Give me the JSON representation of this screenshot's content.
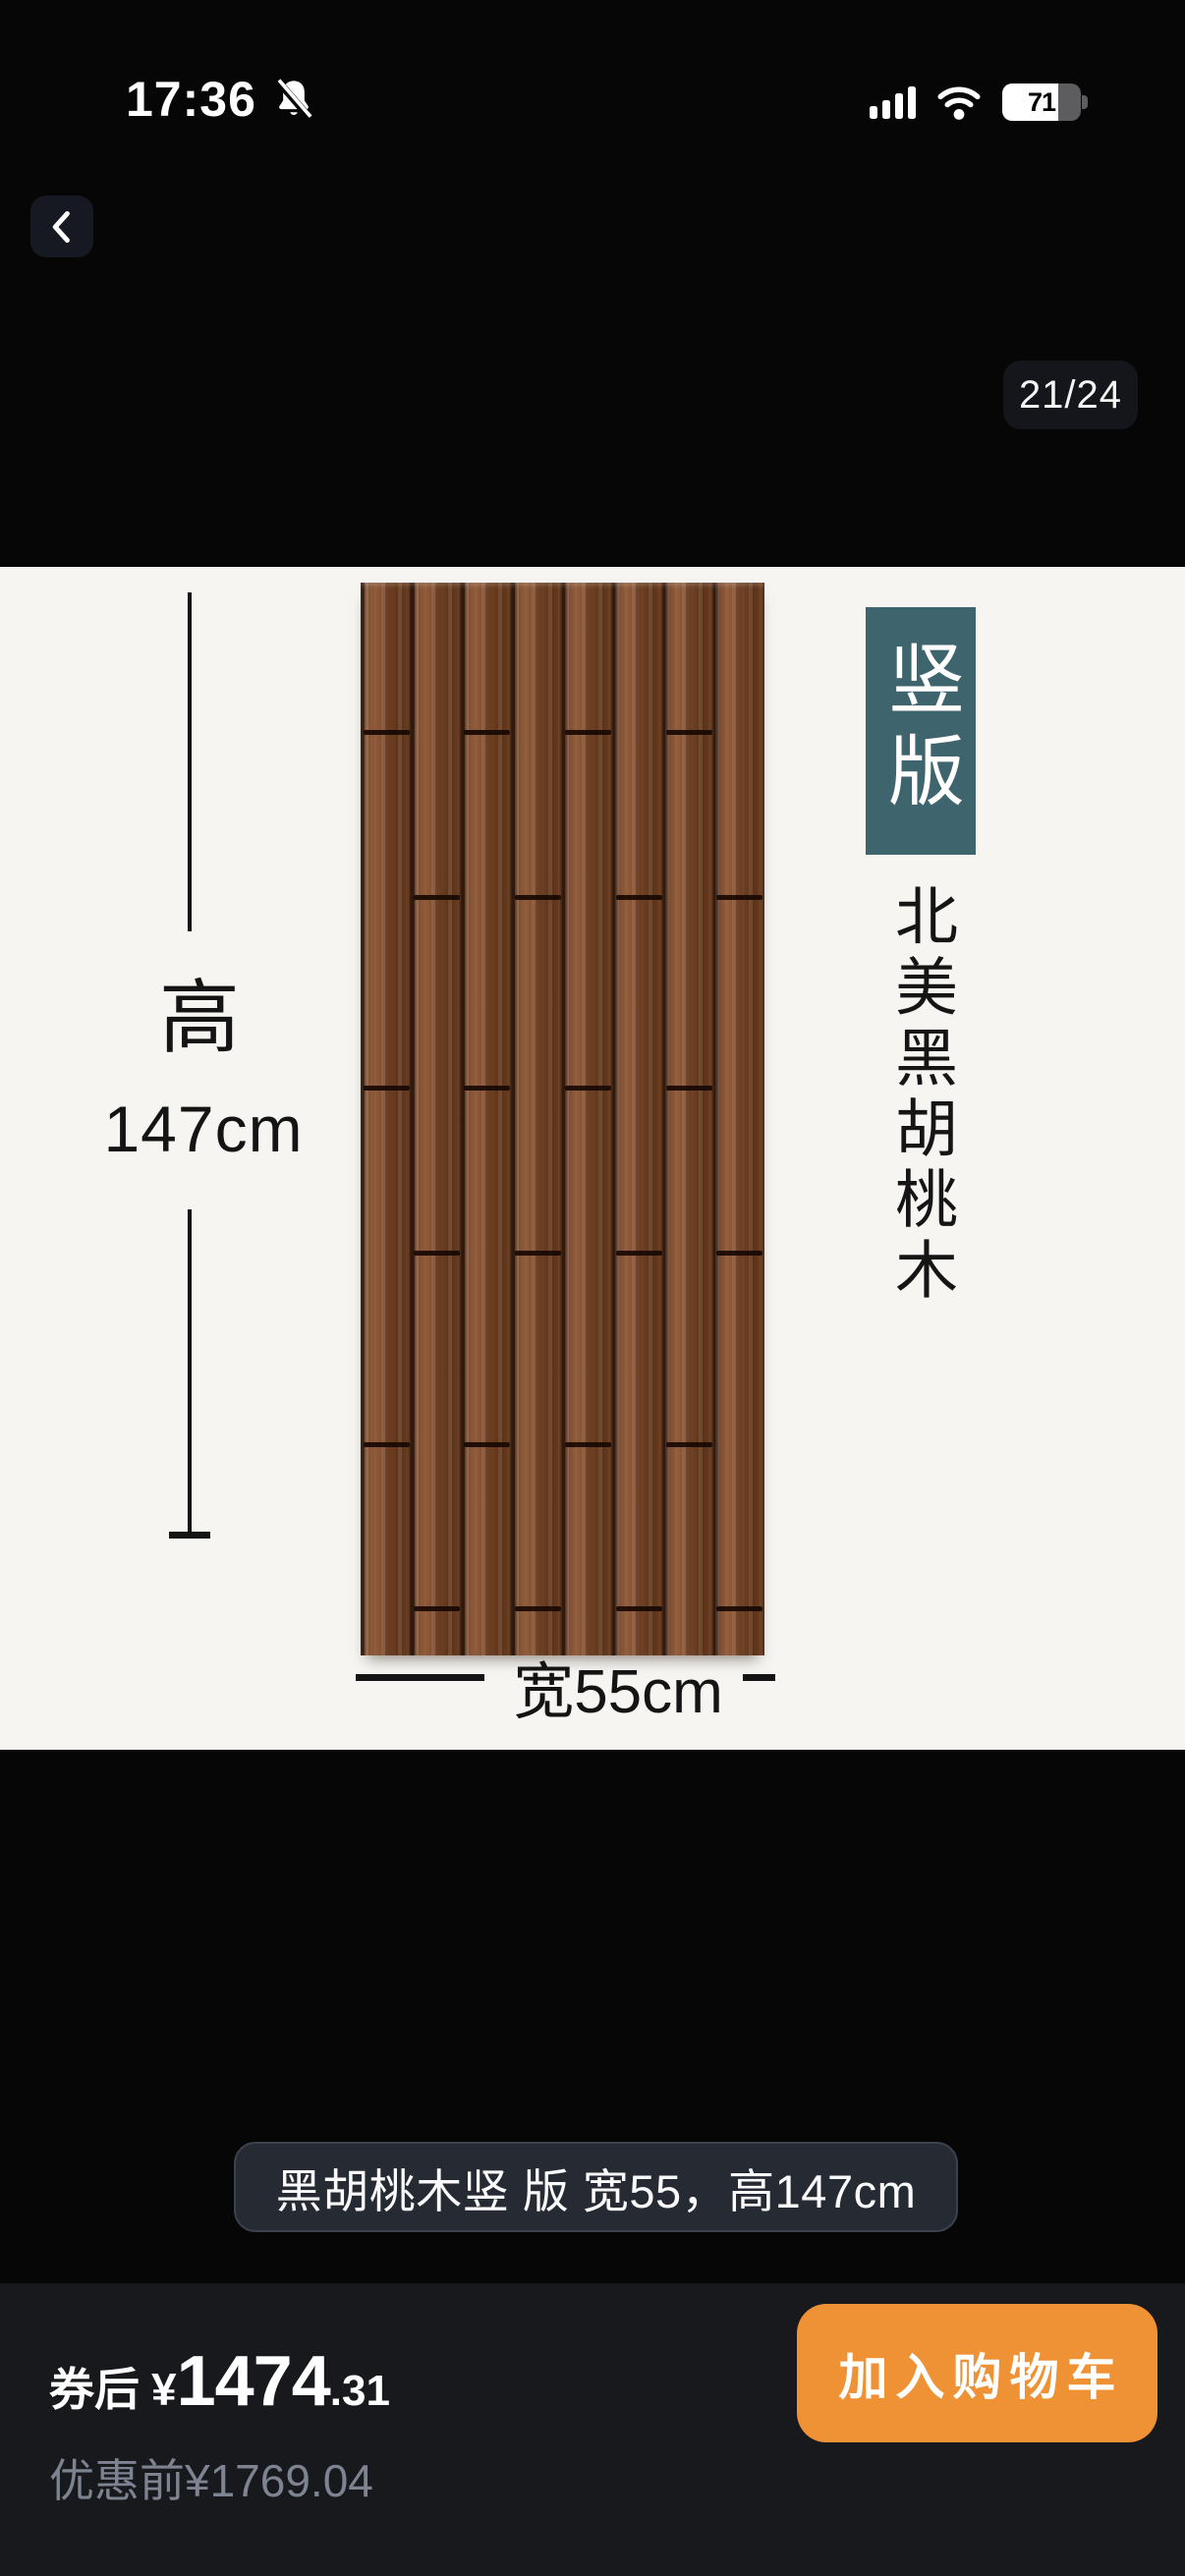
{
  "status_bar": {
    "time": "17:36",
    "battery_percent": "71"
  },
  "viewer": {
    "page_indicator": "21/24"
  },
  "slide": {
    "orientation_badge": "竖版",
    "material_vertical": "北美黑胡桃木",
    "height_prefix": "高",
    "height_value": "147cm",
    "width_label": "宽55cm"
  },
  "caption": {
    "text": "黑胡桃木竖 版 宽55，高147cm"
  },
  "bottom_bar": {
    "coupon_prefix": "券后",
    "currency": "¥",
    "price_int": "1474",
    "price_dec": ".31",
    "original_prefix": "优惠前",
    "original_price": "¥1769.04",
    "add_to_cart_label": "加入购物车"
  },
  "colors": {
    "accent_orange": "#ef9236",
    "badge_teal": "#3e656d",
    "caption_pill_bg": "#252a33",
    "muted_text": "#7d8390",
    "slide_bg": "#f6f5f2"
  }
}
